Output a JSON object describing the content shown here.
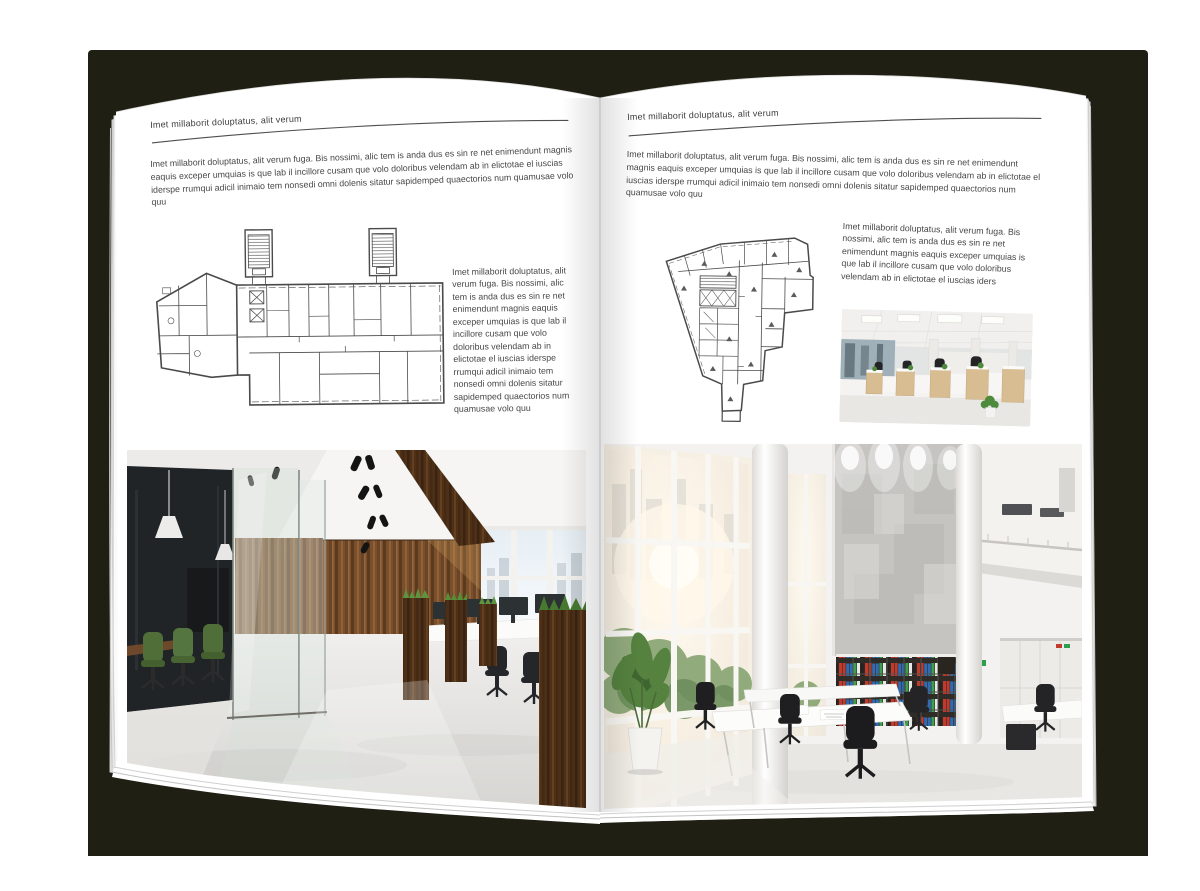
{
  "colors": {
    "backdrop": "#201f13",
    "page": "#ffffff",
    "text": "#474747",
    "rule": "#4f4f4f",
    "plan_line": "#4a4a4a",
    "binder_red": "#c23a2e",
    "binder_blue": "#2f6cb5",
    "binder_green": "#3f9e4d"
  },
  "left_page": {
    "kicker": "Imet millaborit doluptatus, alit verum",
    "intro": "Imet millaborit doluptatus, alit verum fuga. Bis nossimi, alic tem is anda dus es sin re net enimendunt magnis eaquis exceper umquias is que lab il incillore cusam que volo doloribus velendam ab in elictotae el iuscias iderspe rrumqui adicil inimaio tem nonsedi omni dolenis sitatur sapidemped quaectorios num quamusae volo quu",
    "caption": "Imet millaborit doluptatus, alit verum fuga. Bis nossimi, alic tem is anda dus es sin re net enimendunt magnis eaquis exceper umquias is que lab il incillore cusam que volo doloribus velendam ab in elictotae el iuscias iderspe rrumqui adicil inimaio tem nonsedi omni dolenis sitatur sapidemped quaectorios num quamusae volo quu",
    "floor_plan_alt": "Rectangular building floor plan with two stair towers and angled left wing",
    "photo_alt": "Open plan office with dark glass meeting room, green chairs and wooden feature wall"
  },
  "right_page": {
    "kicker": "Imet millaborit doluptatus, alit verum",
    "intro": "Imet millaborit doluptatus, alit verum fuga. Bis nossimi, alic tem is anda dus es sin re net enimendunt magnis eaquis exceper umquias is que lab il incillore cusam que volo doloribus velendam ab in elictotae el iuscias iderspe rrumqui adicil inimaio tem nonsedi omni dolenis sitatur sapidemped quaectorios num quamusae volo quu",
    "caption": "Imet millaborit doluptatus, alit verum fuga. Bis nossimi, alic tem is anda dus es sin re net enimendunt magnis eaquis exceper umquias is que lab il incillore cusam que volo doloribus velendam ab in elictotae el iuscias iders",
    "floor_plan_alt": "Irregular tapering building floor plan with many small rooms and bottom stem",
    "photo_small_alt": "Rows of white and light wood desks with black chairs in a bright office",
    "photo_alt": "Double-height white office atrium with tall windows, concrete wall and bookshelves with colorful binders"
  }
}
